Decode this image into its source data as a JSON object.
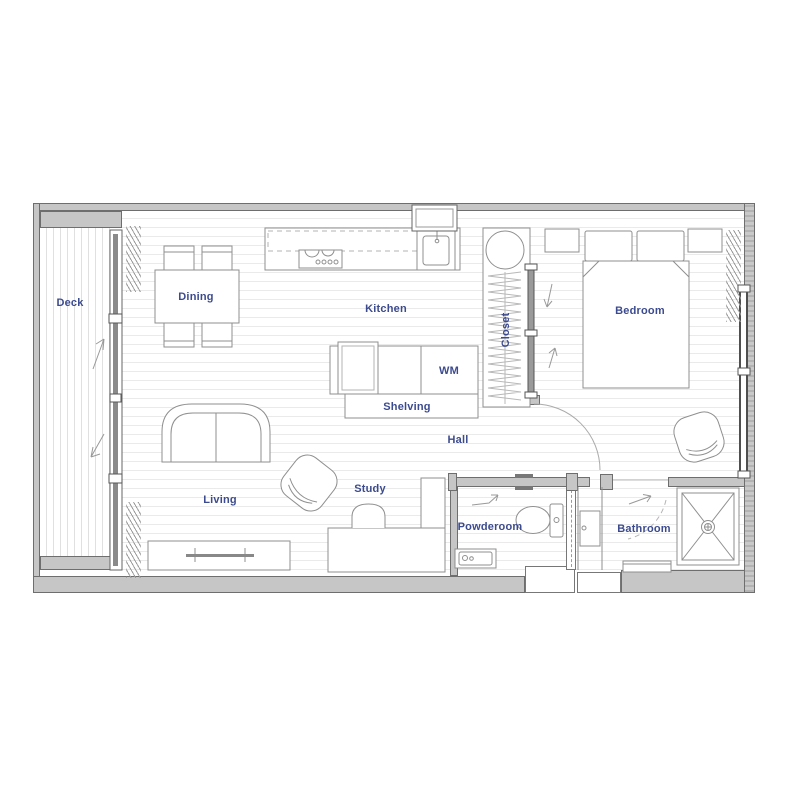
{
  "plan": {
    "type": "apartment-floor-plan",
    "label_color": "#3c4b8f",
    "wall_color": "#c6c6c6",
    "line_color": "#8f8f8f",
    "labels": {
      "deck": "Deck",
      "dining": "Dining",
      "kitchen": "Kitchen",
      "wm": "WM",
      "shelving": "Shelving",
      "closet": "Closet",
      "bedroom": "Bedroom",
      "hall": "Hall",
      "living": "Living",
      "study": "Study",
      "powderoom": "Powderoom",
      "bathroom": "Bathroom"
    },
    "fixtures": [
      "dining-table",
      "dining-chairs",
      "kitchen-counter",
      "overhead-cabinets-dashed",
      "cooktop",
      "kitchen-sink",
      "range-hood-vent",
      "washing-machine",
      "shelving-unit",
      "closet-rail",
      "closet-sliding-doors",
      "double-bed",
      "pillows",
      "nightstands",
      "sofa",
      "armchair",
      "tv-console",
      "study-desk",
      "desk-chair",
      "hall-stool",
      "toilet",
      "hand-basin",
      "vanity-cabinet",
      "shower-with-drain",
      "bath-bench",
      "curtain-coils",
      "door-swing-arcs",
      "deck-sliding-door",
      "bedroom-window"
    ]
  }
}
